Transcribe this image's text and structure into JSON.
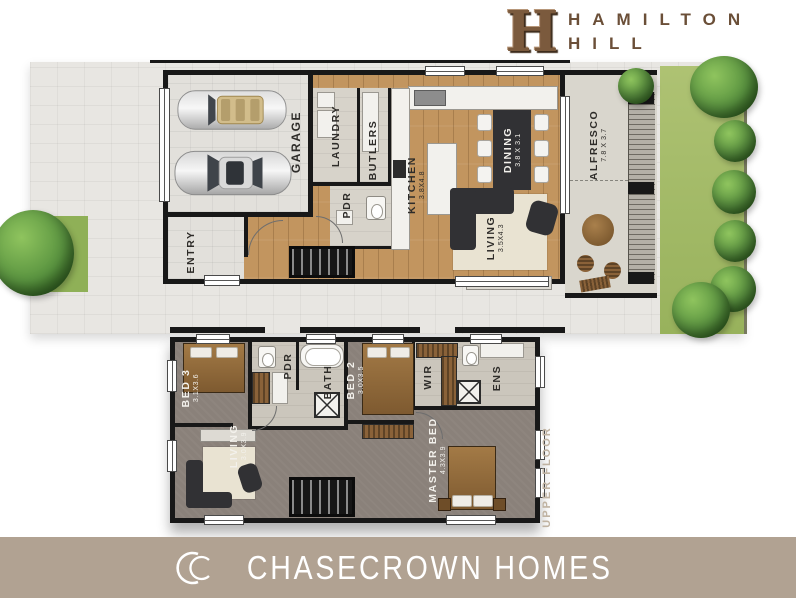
{
  "brand": {
    "emblem": "H",
    "line1": "HAMILTON",
    "line2": "HILL"
  },
  "ground_floor": {
    "rooms": {
      "garage": {
        "label": "GARAGE"
      },
      "entry": {
        "label": "ENTRY"
      },
      "laundry": {
        "label": "LAUNDRY"
      },
      "butlers": {
        "label": "BUTLERS"
      },
      "pdr": {
        "label": "PDR"
      },
      "kitchen": {
        "label": "KITCHEN",
        "dims": "3.8X4.8"
      },
      "dining": {
        "label": "DINING",
        "dims": "3.8 X 3.1"
      },
      "living": {
        "label": "LIVING",
        "dims": "3.5X4.3"
      },
      "alfresco": {
        "label": "ALFRESCO",
        "dims": "7.8 X 3.7"
      }
    }
  },
  "upper_floor": {
    "caption": "UPPER FLOOR",
    "rooms": {
      "bed3": {
        "label": "BED 3",
        "dims": "3.1X3.6"
      },
      "pdr": {
        "label": "PDR"
      },
      "bath": {
        "label": "BATH"
      },
      "bed2": {
        "label": "BED 2",
        "dims": "3.0X3.5"
      },
      "wir": {
        "label": "WIR"
      },
      "ens": {
        "label": "ENS"
      },
      "living": {
        "label": "LIVING",
        "dims": "3.0X3.9"
      },
      "master_bed": {
        "label": "MASTER BED",
        "dims": "4.3X3.9"
      }
    }
  },
  "footer": {
    "company": "CHASECROWN HOMES",
    "logo_icon": "interlocked-cc"
  },
  "colors": {
    "brand_brown": "#6b4f38",
    "footer_taupe": "#b1a292",
    "wood_floor": "#c2955f",
    "upper_carpet": "#89817a",
    "lawn_green": "#a4bd68",
    "wall_black": "#1a1a1a"
  }
}
